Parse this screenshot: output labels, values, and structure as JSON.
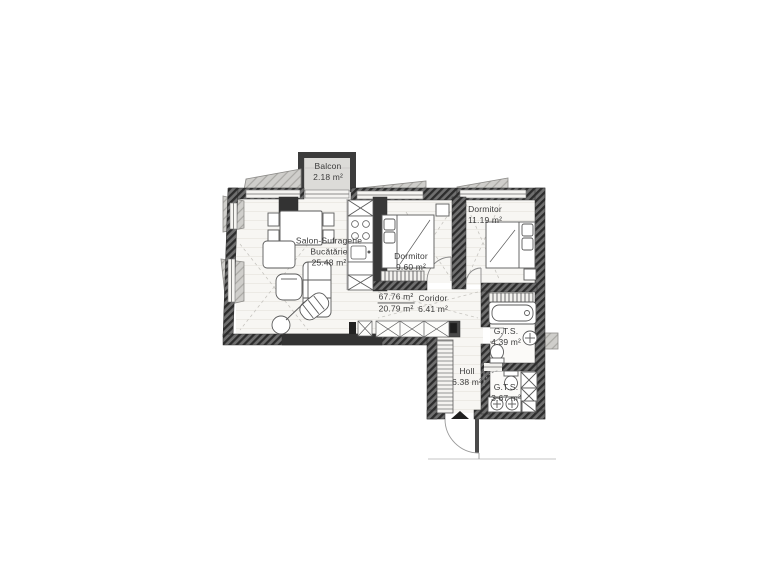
{
  "plan": {
    "balcony": {
      "name": "Balcon",
      "area": "2.18 m²"
    },
    "living": {
      "name_line1": "Salon-Sufragerie",
      "name_line2": "Bucătărie",
      "area": "25.48 m²"
    },
    "bedroom_small": {
      "name": "Dormitor",
      "area": "9.60 m²"
    },
    "bedroom_large": {
      "name": "Dormitor",
      "area": "11.19 m²"
    },
    "corridor": {
      "name": "Coridor",
      "area": "6.41 m²"
    },
    "bathroom_top": {
      "name": "G.T.S.",
      "area": "4.39 m²"
    },
    "hall": {
      "name": "Holl",
      "area": "6.38 m²"
    },
    "bathroom_bottom": {
      "name": "G.T.S.",
      "area": "3.67 m²"
    },
    "area_summary": {
      "total_area": "67.76 m²",
      "secondary_area": "20.79 m²"
    }
  },
  "colors": {
    "wall_dark": "#3c3c3c",
    "slab_gray": "#cfcecb",
    "floor_light": "#f7f6f3",
    "ink": "#3c3c3c",
    "paper": "#ffffff"
  }
}
